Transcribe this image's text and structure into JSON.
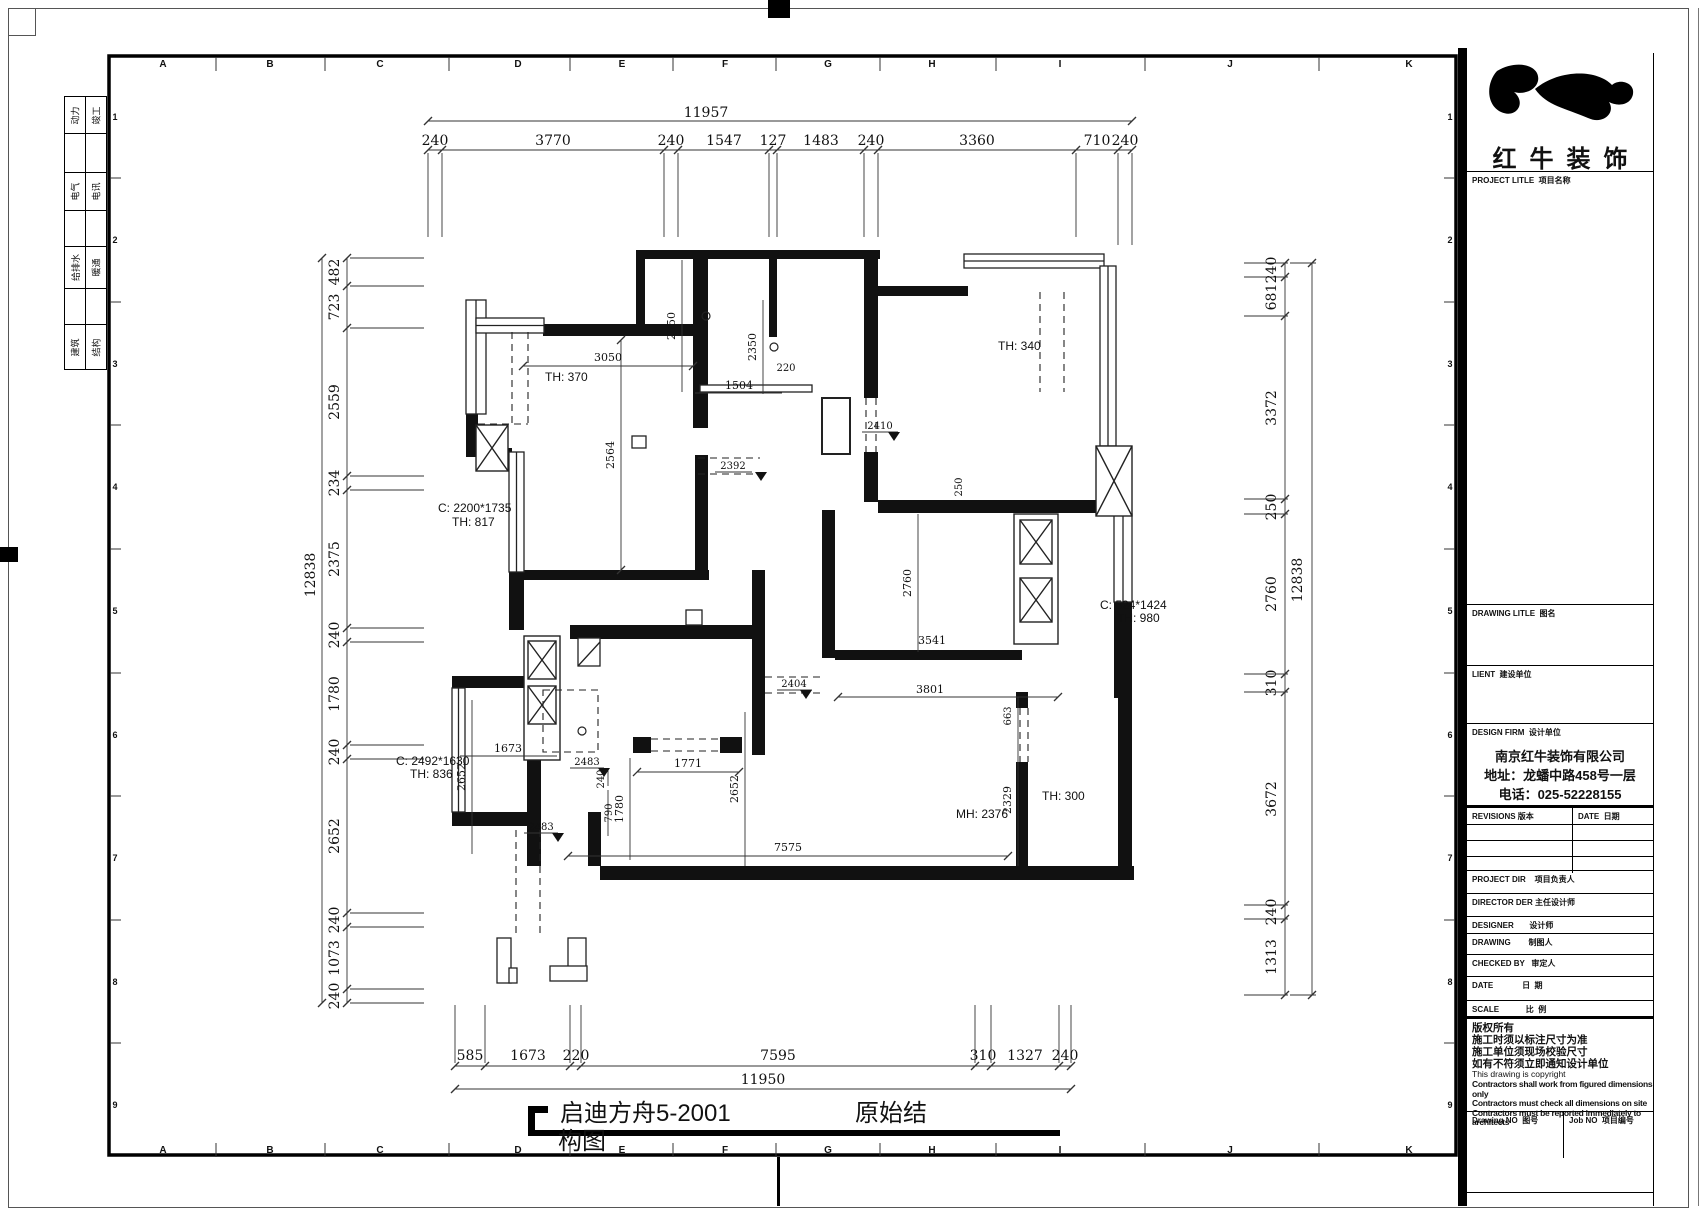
{
  "stamps": {
    "rows": [
      {
        "a": "动力",
        "b": "竣工"
      },
      {
        "a": "电气",
        "b": "电讯"
      },
      {
        "a": "给排水",
        "b": "暖通"
      },
      {
        "a": "建筑",
        "b": "结构"
      }
    ]
  },
  "grid": {
    "letters": [
      "A",
      "B",
      "C",
      "D",
      "E",
      "F",
      "G",
      "H",
      "I",
      "J",
      "K"
    ],
    "numbers": [
      "1",
      "2",
      "3",
      "4",
      "5",
      "6",
      "7",
      "8",
      "9"
    ]
  },
  "dims": {
    "top": {
      "total": "11957",
      "segs": [
        "240",
        "3770",
        "240",
        "1547",
        "127",
        "1483",
        "240",
        "3360",
        "710",
        "240"
      ]
    },
    "bottom": {
      "total": "11950",
      "segs": [
        "585",
        "1673",
        "220",
        "7595",
        "310",
        "1327",
        "240"
      ]
    },
    "left": {
      "total": "12838",
      "segs": [
        "482",
        "723",
        "2559",
        "234",
        "2375",
        "240",
        "1780",
        "240",
        "2652",
        "240",
        "1073",
        "240"
      ]
    },
    "right": {
      "total": "12838",
      "segs": [
        "240",
        "681",
        "3372",
        "250",
        "2760",
        "310",
        "3672",
        "240",
        "1313"
      ]
    },
    "inner": {
      "w3050": "3050",
      "w2564": "2564",
      "w2350a": "2350",
      "w2350b": "2350",
      "w220": "220",
      "w1504": "1504",
      "w2410": "2410",
      "w2392": "2392",
      "w2404": "2404",
      "w2760": "2760",
      "w3541": "3541",
      "w3801": "3801",
      "w663": "663",
      "w2329": "2329",
      "w250": "250",
      "w1771": "1771",
      "w1780": "1780",
      "w1673": "1673",
      "w2652a": "2652",
      "w2652b": "2652",
      "w240": "240",
      "w790": "790",
      "w2483a": "2483",
      "w2483b": "2483",
      "w7575": "7575"
    }
  },
  "labels": {
    "th370": "TH: 370",
    "th340": "TH: 340",
    "c2200": "C: 2200*1735",
    "th817": "TH: 817",
    "c524": "C: 524*1424",
    "th980": "TH: 980",
    "c2492": "C: 2492*1630",
    "th836": "TH: 836",
    "mh2376": "MH: 2376",
    "th300": "TH: 300"
  },
  "plan_title": {
    "name": "启迪方舟5-2001",
    "suffix": "原始结",
    "wrap": "构图"
  },
  "titleblock": {
    "brand": "红牛装饰",
    "project_title": "PROJECT LITLE  项目名称",
    "drawing_title": "DRAWING LITLE  图名",
    "client": "LIENT  建设单位",
    "design_firm": "DESIGN FIRM  设计单位",
    "firm_name": "南京红牛装饰有限公司",
    "firm_addr": "地址：龙蟠中路458号一层",
    "firm_tel": "电话：025-52228155",
    "revisions": "REVISIONS 版本",
    "date_col": "DATE  日期",
    "project_dir": "PROJECT DIR    项目负责人",
    "director": "DIRECTOR DER 主任设计师",
    "designer": "DESIGNER       设计师",
    "drawing_by": "DRAWING        制图人",
    "checked_by": "CHECKED BY   审定人",
    "date_row": "DATE             日  期",
    "scale_row": "SCALE            比  例",
    "notes": [
      "版权所有",
      "施工时须以标注尺寸为准",
      "施工单位须现场校验尺寸",
      "如有不符须立即通知设计单位",
      "This drawing is copyright",
      "Contractors shall work from figured dimensions only",
      "Contractors must check all dimensions on site",
      "Contractors must be reported immediately to architects"
    ],
    "drawing_no": "Drawing NO  图号",
    "job_no": "Job NO  项目编号"
  }
}
